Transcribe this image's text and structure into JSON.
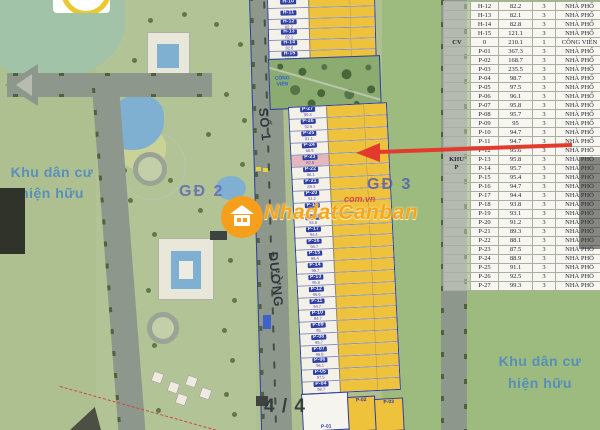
{
  "watermark": {
    "brand": "NhadatCanban",
    "domain": "com.vn"
  },
  "page_marker": "4 / 4",
  "map": {
    "labels": {
      "residential_left_line1": "Khu dân cư",
      "residential_left_line2": "hiện hữu",
      "residential_right_line1": "Khu dân cư",
      "residential_right_line2": "hiện hữu",
      "phase2": "GĐ 2",
      "phase3": "GĐ 3",
      "park_line1": "CÔNG",
      "park_line2": "VIÊN",
      "street_number": "SỐ 1",
      "street_word": "ĐƯỜNG"
    },
    "h_lots": [
      {
        "id": "H-10",
        "area": ""
      },
      {
        "id": "H-11",
        "area": ""
      },
      {
        "id": "H-12",
        "area": "82.2"
      },
      {
        "id": "H-13",
        "area": "82.1"
      },
      {
        "id": "H-14",
        "area": "82.8"
      },
      {
        "id": "H-15",
        "area": "121.1"
      }
    ],
    "p_lots_top_to_bottom": [
      {
        "id": "P-27",
        "area": "99.3"
      },
      {
        "id": "P-26",
        "area": "92.5"
      },
      {
        "id": "P-25",
        "area": "91.1"
      },
      {
        "id": "P-24",
        "area": "88.9"
      },
      {
        "id": "P-23",
        "area": "87.5"
      },
      {
        "id": "P-22",
        "area": "88.1"
      },
      {
        "id": "P-21",
        "area": "89.3"
      },
      {
        "id": "P-20",
        "area": "91.2"
      },
      {
        "id": "P-19",
        "area": "93.1"
      },
      {
        "id": "P-18",
        "area": "93.8"
      },
      {
        "id": "P-17",
        "area": "94.4"
      },
      {
        "id": "P-16",
        "area": "94.7"
      },
      {
        "id": "P-15",
        "area": "95.4"
      },
      {
        "id": "P-14",
        "area": "95.7"
      },
      {
        "id": "P-13",
        "area": "95.8"
      },
      {
        "id": "P-12",
        "area": "95.6"
      },
      {
        "id": "P-11",
        "area": "94.7"
      },
      {
        "id": "P-10",
        "area": "94.7"
      },
      {
        "id": "P-09",
        "area": "95"
      },
      {
        "id": "P-08",
        "area": "95.7"
      },
      {
        "id": "P-07",
        "area": "95.8"
      },
      {
        "id": "P-06",
        "area": "96.1"
      },
      {
        "id": "P-05",
        "area": "97.5"
      },
      {
        "id": "P-04",
        "area": "98.7"
      }
    ],
    "bottom_lots": [
      {
        "id": "P-01",
        "area": "367.3"
      },
      {
        "id": "P-02",
        "area": "168.7"
      },
      {
        "id": "P-03",
        "area": "235.5"
      }
    ],
    "highlighted_lot": "P-23"
  },
  "table": {
    "group_labels": {
      "cv": "CV",
      "khu_line1": "KHU",
      "khu_line2": "P"
    },
    "rows": [
      {
        "group": "",
        "id": "H-12",
        "area": "82.2",
        "floors": "3",
        "type": "NHÀ PHỐ"
      },
      {
        "group": "",
        "id": "H-13",
        "area": "82.1",
        "floors": "3",
        "type": "NHÀ PHỐ"
      },
      {
        "group": "",
        "id": "H-14",
        "area": "82.8",
        "floors": "3",
        "type": "NHÀ PHỐ"
      },
      {
        "group": "",
        "id": "H-15",
        "area": "121.1",
        "floors": "3",
        "type": "NHÀ PHỐ"
      },
      {
        "group": "CV",
        "id": "0",
        "area": "210.1",
        "floors": "1",
        "type": "CÔNG VIÊN"
      },
      {
        "group": "",
        "id": "P-01",
        "area": "367.3",
        "floors": "3",
        "type": "NHÀ PHỐ"
      },
      {
        "group": "",
        "id": "P-02",
        "area": "168.7",
        "floors": "3",
        "type": "NHÀ PHỐ"
      },
      {
        "group": "",
        "id": "P-03",
        "area": "235.5",
        "floors": "3",
        "type": "NHÀ PHỐ"
      },
      {
        "group": "",
        "id": "P-04",
        "area": "98.7",
        "floors": "3",
        "type": "NHÀ PHỐ"
      },
      {
        "group": "",
        "id": "P-05",
        "area": "97.5",
        "floors": "3",
        "type": "NHÀ PHỐ"
      },
      {
        "group": "",
        "id": "P-06",
        "area": "96.1",
        "floors": "3",
        "type": "NHÀ PHỐ"
      },
      {
        "group": "",
        "id": "P-07",
        "area": "95.8",
        "floors": "3",
        "type": "NHÀ PHỐ"
      },
      {
        "group": "",
        "id": "P-08",
        "area": "95.7",
        "floors": "3",
        "type": "NHÀ PHỐ"
      },
      {
        "group": "",
        "id": "P-09",
        "area": "95",
        "floors": "3",
        "type": "NHÀ PHỐ"
      },
      {
        "group": "",
        "id": "P-10",
        "area": "94.7",
        "floors": "3",
        "type": "NHÀ PHỐ"
      },
      {
        "group": "",
        "id": "P-11",
        "area": "94.7",
        "floors": "3",
        "type": "NHÀ PHỐ"
      },
      {
        "group": "",
        "id": "P-12",
        "area": "95.6",
        "floors": "3",
        "type": "NHÀ PHỐ"
      },
      {
        "group": "",
        "id": "P-13",
        "area": "95.8",
        "floors": "3",
        "type": "NHÀ PHỐ"
      },
      {
        "group": "",
        "id": "P-14",
        "area": "95.7",
        "floors": "3",
        "type": "NHÀ PHỐ"
      },
      {
        "group": "",
        "id": "P-15",
        "area": "95.4",
        "floors": "3",
        "type": "NHÀ PHỐ"
      },
      {
        "group": "",
        "id": "P-16",
        "area": "94.7",
        "floors": "3",
        "type": "NHÀ PHỐ"
      },
      {
        "group": "",
        "id": "P-17",
        "area": "94.4",
        "floors": "3",
        "type": "NHÀ PHỐ"
      },
      {
        "group": "",
        "id": "P-18",
        "area": "93.8",
        "floors": "3",
        "type": "NHÀ PHỐ"
      },
      {
        "group": "",
        "id": "P-19",
        "area": "93.1",
        "floors": "3",
        "type": "NHÀ PHỐ"
      },
      {
        "group": "",
        "id": "P-20",
        "area": "91.2",
        "floors": "3",
        "type": "NHÀ PHỐ"
      },
      {
        "group": "",
        "id": "P-21",
        "area": "89.3",
        "floors": "3",
        "type": "NHÀ PHỐ"
      },
      {
        "group": "",
        "id": "P-22",
        "area": "88.1",
        "floors": "3",
        "type": "NHÀ PHỐ"
      },
      {
        "group": "",
        "id": "P-23",
        "area": "87.5",
        "floors": "3",
        "type": "NHÀ PHỐ"
      },
      {
        "group": "",
        "id": "P-24",
        "area": "88.9",
        "floors": "3",
        "type": "NHÀ PHỐ"
      },
      {
        "group": "",
        "id": "P-25",
        "area": "91.1",
        "floors": "3",
        "type": "NHÀ PHỐ"
      },
      {
        "group": "",
        "id": "P-26",
        "area": "92.5",
        "floors": "3",
        "type": "NHÀ PHỐ"
      },
      {
        "group": "",
        "id": "P-27",
        "area": "99.3",
        "floors": "3",
        "type": "NHÀ PHỐ"
      }
    ]
  }
}
